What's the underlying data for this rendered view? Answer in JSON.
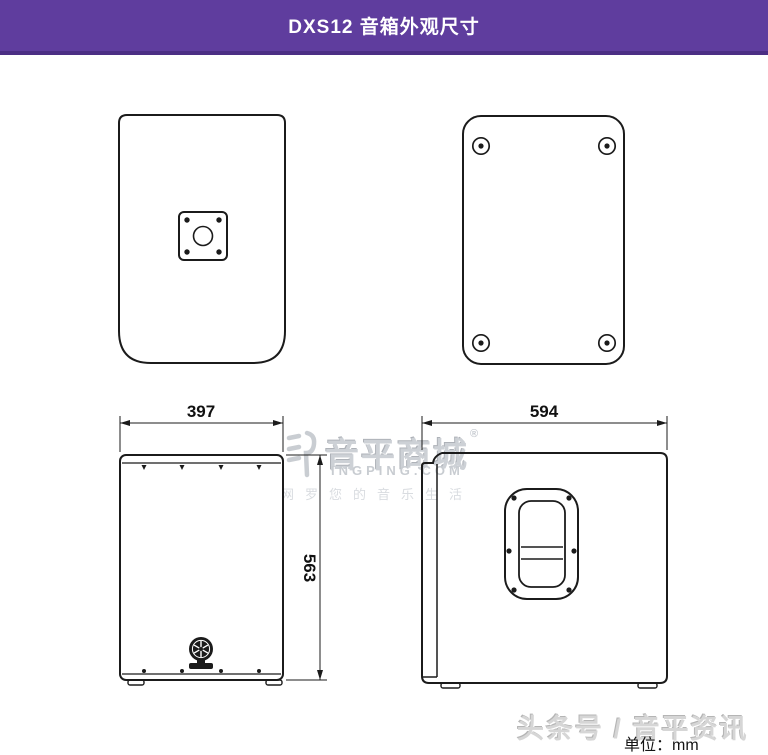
{
  "header": {
    "title": "DXS12 音箱外观尺寸"
  },
  "drawing": {
    "dimensions": {
      "front_width": "397",
      "front_height": "563",
      "side_depth": "594"
    },
    "unit_note": "单位：mm"
  },
  "watermark": {
    "brand": "音平商城",
    "reg_mark": "®",
    "domain": "INGPING.COM",
    "tagline": "网罗您的音乐生活"
  },
  "footer": {
    "credit": "头条号 / 音平资讯"
  },
  "colors": {
    "header_bg": "#5f3d9e",
    "header_border": "#4b2e84",
    "line": "#1b1b1b",
    "watermark_gray": "#cdd1d6"
  }
}
